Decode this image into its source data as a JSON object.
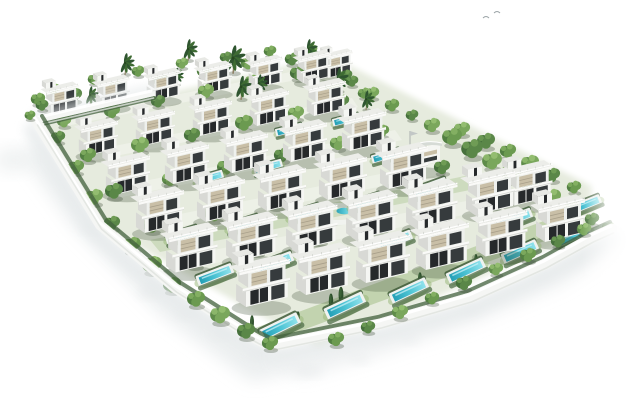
{
  "scene": {
    "canvas": {
      "width": 630,
      "height": 403
    },
    "colors": {
      "background": "#ffffff",
      "villa_white": "#f5f6f3",
      "villa_white2": "#eef0ed",
      "villa_side": "#d8d9d5",
      "villa_deck": "#ecede9",
      "glazing_dark": "#26292b",
      "glazing_mid": "#363b3d",
      "louver_beige": "#c9bfa7",
      "slab_white": "#fafaf8",
      "pool_deck": "#eff2f0",
      "pool_water_deep": "#249fb6",
      "pool_water_mid": "#4cc3d4",
      "pool_water_light": "#8fe2ec",
      "site_green": "#e6ebde",
      "street_light": "#f3f5ef",
      "lawn_green": "#96b575",
      "hedge_green": "#42603c",
      "wall_white": "#f5f6f4",
      "shadow_grey": "#e6eaeb"
    },
    "tree_palettes": [
      [
        "#46703c",
        "#5a8748",
        "#6f9c55"
      ],
      [
        "#527f42",
        "#6b9a50",
        "#83af62"
      ],
      [
        "#5f8c4a",
        "#7aa75c",
        "#93bd70"
      ],
      [
        "#6d9750",
        "#86b268",
        "#a2c77e"
      ]
    ],
    "site_outline": "40,122 330,56 592,186 592,230 318,348 102,226",
    "villas": [
      [
        44,
        80,
        0.7
      ],
      [
        95,
        73,
        0.7
      ],
      [
        146,
        66,
        0.7
      ],
      [
        197,
        59,
        0.7
      ],
      [
        248,
        53,
        0.7
      ],
      [
        296,
        48,
        0.7
      ],
      [
        322,
        47,
        0.62
      ],
      [
        78,
        116,
        0.8
      ],
      [
        135,
        106,
        0.8
      ],
      [
        192,
        96,
        0.8
      ],
      [
        249,
        86,
        0.8
      ],
      [
        306,
        76,
        0.8
      ],
      [
        105,
        150,
        0.9
      ],
      [
        164,
        139,
        0.9
      ],
      [
        223,
        128,
        0.9
      ],
      [
        282,
        117,
        0.9
      ],
      [
        341,
        106,
        0.9
      ],
      [
        135,
        184,
        0.98
      ],
      [
        196,
        173,
        0.98
      ],
      [
        257,
        162,
        0.98
      ],
      [
        318,
        151,
        0.98
      ],
      [
        379,
        140,
        0.98
      ],
      [
        165,
        220,
        1.05
      ],
      [
        225,
        209,
        1.05
      ],
      [
        285,
        198,
        1.05
      ],
      [
        345,
        187,
        1.05
      ],
      [
        405,
        176,
        1.05
      ],
      [
        465,
        165,
        1.0
      ],
      [
        505,
        158,
        0.95
      ],
      [
        235,
        252,
        1.1
      ],
      [
        295,
        240,
        1.1
      ],
      [
        355,
        228,
        1.1
      ],
      [
        415,
        216,
        1.08
      ],
      [
        475,
        204,
        1.05
      ],
      [
        535,
        192,
        1.0
      ]
    ],
    "pools": [
      [
        289,
        130,
        0.65,
        -14
      ],
      [
        346,
        120,
        0.65,
        -14
      ],
      [
        209,
        178,
        0.7,
        -16
      ],
      [
        268,
        167,
        0.7,
        -16
      ],
      [
        386,
        156,
        0.7,
        -16
      ],
      [
        182,
        235,
        0.8,
        -18
      ],
      [
        243,
        224,
        0.8,
        -18
      ],
      [
        304,
        213,
        0.8,
        -18
      ],
      [
        365,
        202,
        0.8,
        -18
      ],
      [
        430,
        188,
        0.85,
        -20
      ],
      [
        215,
        275,
        0.9,
        -21
      ],
      [
        275,
        263,
        0.9,
        -21
      ],
      [
        395,
        241,
        0.85,
        -21
      ],
      [
        515,
        219,
        0.85,
        -21
      ],
      [
        585,
        205,
        0.8,
        -22
      ],
      [
        280,
        327,
        1.0,
        -26
      ],
      [
        345,
        306,
        1.0,
        -25
      ],
      [
        409,
        291,
        0.95,
        -25
      ],
      [
        466,
        271,
        0.95,
        -25
      ],
      [
        520,
        252,
        0.9,
        -24
      ],
      [
        574,
        236,
        0.85,
        -24
      ]
    ],
    "trees": [
      [
        38,
        100,
        0.8,
        1,
        0
      ],
      [
        54,
        90,
        0.7,
        2,
        0
      ],
      [
        74,
        96,
        0.9,
        0,
        0
      ],
      [
        94,
        80,
        0.7,
        1,
        0
      ],
      [
        116,
        88,
        0.8,
        2,
        0
      ],
      [
        138,
        72,
        0.7,
        1,
        0
      ],
      [
        160,
        80,
        0.9,
        0,
        0
      ],
      [
        182,
        64,
        0.7,
        2,
        0
      ],
      [
        204,
        72,
        0.8,
        1,
        0
      ],
      [
        226,
        58,
        0.7,
        0,
        0
      ],
      [
        248,
        64,
        0.8,
        2,
        0
      ],
      [
        270,
        52,
        0.7,
        1,
        0
      ],
      [
        292,
        60,
        0.8,
        0,
        0
      ],
      [
        312,
        50,
        0.6,
        2,
        0
      ],
      [
        334,
        64,
        0.8,
        1,
        0
      ],
      [
        346,
        76,
        0.7,
        0,
        0
      ],
      [
        64,
        122,
        0.8,
        2,
        0
      ],
      [
        112,
        112,
        0.9,
        1,
        0
      ],
      [
        158,
        102,
        0.8,
        0,
        0
      ],
      [
        206,
        92,
        0.9,
        2,
        0
      ],
      [
        252,
        82,
        0.8,
        1,
        0
      ],
      [
        298,
        74,
        0.9,
        0,
        0
      ],
      [
        332,
        88,
        0.8,
        2,
        0
      ],
      [
        88,
        156,
        0.9,
        1,
        0
      ],
      [
        140,
        146,
        1.0,
        2,
        0
      ],
      [
        192,
        136,
        0.9,
        0,
        0
      ],
      [
        244,
        124,
        1.0,
        1,
        0
      ],
      [
        296,
        114,
        0.9,
        2,
        0
      ],
      [
        342,
        102,
        0.8,
        0,
        0
      ],
      [
        364,
        94,
        0.7,
        1,
        0
      ],
      [
        114,
        192,
        1.0,
        0,
        0
      ],
      [
        170,
        180,
        0.9,
        2,
        0
      ],
      [
        226,
        168,
        1.0,
        1,
        0
      ],
      [
        282,
        156,
        0.9,
        0,
        0
      ],
      [
        338,
        144,
        0.9,
        2,
        0
      ],
      [
        382,
        132,
        0.8,
        1,
        0
      ],
      [
        352,
        82,
        0.7,
        0,
        0
      ],
      [
        372,
        94,
        0.8,
        2,
        0
      ],
      [
        392,
        106,
        0.8,
        1,
        0
      ],
      [
        412,
        116,
        0.7,
        0,
        0
      ],
      [
        432,
        126,
        0.9,
        2,
        0
      ],
      [
        452,
        138,
        1.1,
        1,
        0
      ],
      [
        472,
        150,
        1.2,
        0,
        0
      ],
      [
        492,
        162,
        1.1,
        2,
        0
      ],
      [
        512,
        174,
        1.2,
        1,
        0
      ],
      [
        532,
        186,
        1.1,
        0,
        0
      ],
      [
        552,
        198,
        1.0,
        2,
        0
      ],
      [
        572,
        210,
        0.9,
        1,
        0
      ],
      [
        592,
        220,
        0.8,
        0,
        0
      ],
      [
        608,
        228,
        0.7,
        2,
        0
      ],
      [
        462,
        130,
        0.9,
        2,
        0
      ],
      [
        486,
        142,
        1.0,
        0,
        0
      ],
      [
        508,
        152,
        0.9,
        1,
        0
      ],
      [
        530,
        164,
        1.0,
        2,
        0
      ],
      [
        552,
        176,
        0.9,
        0,
        0
      ],
      [
        574,
        188,
        0.8,
        1,
        0
      ],
      [
        152,
        226,
        1.0,
        1,
        0
      ],
      [
        214,
        214,
        1.1,
        2,
        0
      ],
      [
        276,
        202,
        1.0,
        0,
        0
      ],
      [
        338,
        190,
        1.0,
        1,
        0
      ],
      [
        400,
        180,
        0.9,
        2,
        0
      ],
      [
        442,
        168,
        0.9,
        0,
        0
      ],
      [
        194,
        260,
        1.1,
        0,
        0
      ],
      [
        256,
        248,
        1.0,
        2,
        0
      ],
      [
        318,
        236,
        1.1,
        1,
        0
      ],
      [
        380,
        224,
        1.0,
        0,
        0
      ],
      [
        442,
        212,
        1.0,
        2,
        0
      ],
      [
        494,
        202,
        0.9,
        1,
        0
      ],
      [
        58,
        138,
        0.8,
        0,
        0
      ],
      [
        76,
        168,
        0.9,
        1,
        0
      ],
      [
        94,
        198,
        1.0,
        2,
        0
      ],
      [
        112,
        224,
        0.9,
        0,
        0
      ],
      [
        132,
        246,
        1.0,
        1,
        0
      ],
      [
        152,
        266,
        1.1,
        2,
        0
      ],
      [
        172,
        286,
        1.0,
        0,
        0
      ],
      [
        196,
        300,
        1.0,
        1,
        1
      ],
      [
        220,
        316,
        1.1,
        2,
        1
      ],
      [
        246,
        332,
        1.0,
        0,
        1
      ],
      [
        270,
        344,
        0.9,
        1,
        1
      ],
      [
        42,
        106,
        0.7,
        0,
        1
      ],
      [
        30,
        116,
        0.6,
        1,
        1
      ],
      [
        336,
        340,
        0.9,
        1,
        1
      ],
      [
        368,
        328,
        0.8,
        0,
        1
      ],
      [
        400,
        313,
        0.9,
        2,
        1
      ],
      [
        432,
        299,
        0.8,
        1,
        1
      ],
      [
        464,
        284,
        0.9,
        0,
        1
      ],
      [
        496,
        270,
        0.8,
        2,
        1
      ],
      [
        528,
        256,
        0.9,
        1,
        1
      ],
      [
        558,
        242,
        0.8,
        0,
        1
      ],
      [
        584,
        230,
        0.8,
        2,
        1
      ]
    ],
    "palms": [
      [
        125,
        66,
        1.0
      ],
      [
        188,
        52,
        1.0
      ],
      [
        233,
        62,
        1.3
      ],
      [
        241,
        90,
        1.1
      ],
      [
        259,
        86,
        0.9
      ],
      [
        308,
        52,
        1.0
      ],
      [
        338,
        82,
        1.1
      ],
      [
        90,
        98,
        0.9
      ],
      [
        176,
        78,
        0.8
      ],
      [
        366,
        102,
        0.9
      ],
      [
        506,
        172,
        0.8
      ]
    ],
    "cypresses": [
      [
        331,
        301,
        1.0
      ],
      [
        341,
        295,
        1.1
      ],
      [
        298,
        318,
        0.9
      ],
      [
        420,
        279,
        0.9
      ],
      [
        476,
        260,
        0.8
      ],
      [
        252,
        322,
        0.9
      ]
    ],
    "clubhouse": {
      "x": 396,
      "y": 136
    },
    "deck_feature": {
      "cx": 338,
      "cy": 214,
      "rx": 21,
      "ry": 8.5,
      "pool_rx": 7.5,
      "pool_ry": 3.2
    },
    "walls": {
      "nw": {
        "d": "M36,121 L152,94",
        "w": 5,
        "shadow_dx": -1,
        "shadow_dy": -4,
        "hedge_dx": 2,
        "hedge_dy": 4
      },
      "sw": {
        "d": "M36,121 L100,225 L175,288 L246,333 Q260,342 272,346",
        "w": 10,
        "shadow_dx": -5,
        "shadow_dy": 9,
        "hedge_dx": 6,
        "hedge_dy": -5
      },
      "se": {
        "d": "M272,346 L380,324 L470,298 L545,264 L592,238 L612,229",
        "w": 11,
        "shadow_dx": 4,
        "shadow_dy": 10,
        "hedge_dx": -2,
        "hedge_dy": -7
      }
    },
    "streets": [
      {
        "pts": "60,118 310,68 316,76 66,126",
        "op": 0.6
      },
      {
        "pts": "85,152 352,98 358,107 91,161",
        "op": 0.6
      },
      {
        "pts": "110,188 395,130 402,140 117,198",
        "op": 0.6
      },
      {
        "pts": "140,222 440,162 448,173 148,233",
        "op": 0.55
      },
      {
        "pts": "172,258 492,196 500,208 180,270",
        "op": 0.5
      }
    ],
    "lawns": [
      {
        "pts": "250,330 560,215 580,228 262,345",
        "op": 0.45
      },
      {
        "pts": "150,240 470,175 480,188 160,252",
        "op": 0.3
      }
    ],
    "shadow_blobs": [
      {
        "type": "poly",
        "pts": "40,140 110,240 200,310 268,355 312,368 252,382 162,316 72,226 22,156",
        "blur": 8,
        "fill": "#e6eaeb",
        "op": 0.75
      },
      {
        "type": "poly",
        "pts": "272,358 382,334 472,306 547,272 600,242 614,236 620,248 560,286 470,324 382,354 302,377",
        "blur": 8,
        "fill": "#e8ebec",
        "op": 0.7
      },
      {
        "type": "ell",
        "cx": 14,
        "cy": 160,
        "rx": 20,
        "ry": 12,
        "blur": 8,
        "fill": "#eef1f1",
        "op": 0.9
      },
      {
        "type": "ell",
        "cx": 150,
        "cy": 292,
        "rx": 12,
        "ry": 6,
        "blur": 5,
        "fill": "#e6e9ea",
        "op": 0.6
      },
      {
        "type": "ell",
        "cx": 186,
        "cy": 314,
        "rx": 11,
        "ry": 5,
        "blur": 5,
        "fill": "#e6e9ea",
        "op": 0.55
      },
      {
        "type": "ell",
        "cx": 222,
        "cy": 334,
        "rx": 12,
        "ry": 5,
        "blur": 5,
        "fill": "#e6e9ea",
        "op": 0.55
      },
      {
        "type": "ell",
        "cx": 258,
        "cy": 354,
        "rx": 11,
        "ry": 5,
        "blur": 5,
        "fill": "#e6e9ea",
        "op": 0.5
      },
      {
        "type": "ell",
        "cx": 310,
        "cy": 372,
        "rx": 14,
        "ry": 5,
        "blur": 5,
        "fill": "#e6e9ea",
        "op": 0.5
      },
      {
        "type": "ell",
        "cx": 360,
        "cy": 360,
        "rx": 10,
        "ry": 4,
        "blur": 5,
        "fill": "#e6e9ea",
        "op": 0.45
      },
      {
        "type": "ell",
        "cx": 90,
        "cy": 228,
        "rx": 10,
        "ry": 5,
        "blur": 5,
        "fill": "#e6e9ea",
        "op": 0.5
      },
      {
        "type": "ell",
        "cx": 410,
        "cy": 340,
        "rx": 10,
        "ry": 4,
        "blur": 5,
        "fill": "#e6e9ea",
        "op": 0.45
      },
      {
        "type": "ell",
        "cx": 470,
        "cy": 310,
        "rx": 9,
        "ry": 4,
        "blur": 5,
        "fill": "#e6e9ea",
        "op": 0.4
      },
      {
        "type": "ell",
        "cx": 540,
        "cy": 275,
        "rx": 9,
        "ry": 4,
        "blur": 5,
        "fill": "#e6e9ea",
        "op": 0.4
      }
    ],
    "birds": [
      [
        483,
        18
      ],
      [
        494,
        13
      ]
    ],
    "fade_right": {
      "x": 582,
      "width": 48
    }
  }
}
